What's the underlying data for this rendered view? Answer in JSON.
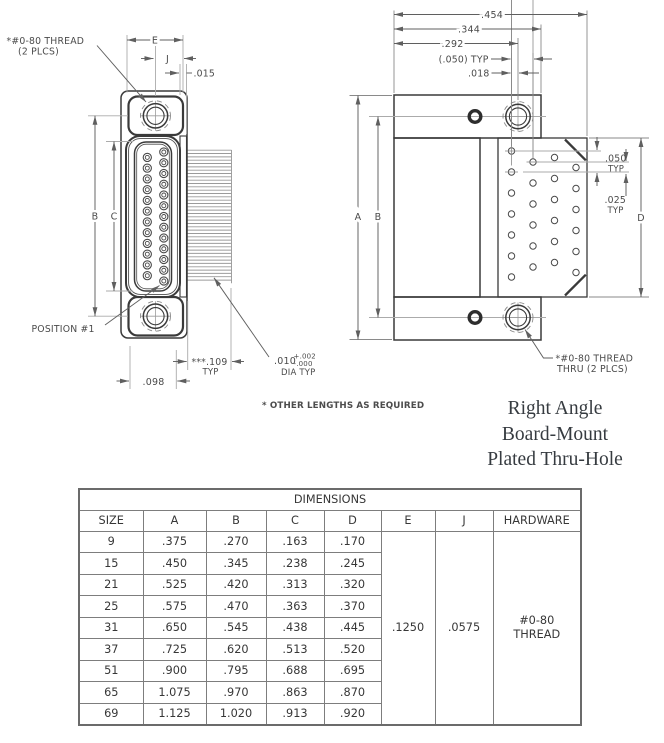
{
  "drawing": {
    "front_view": {
      "thread_label_line1": "*#0-80 THREAD",
      "thread_label_line2": "(2 PLCS)",
      "dim_e": "E",
      "dim_j": "J",
      "dim_015": ".015",
      "dim_b": "B",
      "dim_c": "C",
      "position_label": "POSITION #1",
      "dim_098": ".098",
      "dim_109": "***.109",
      "dim_109_typ": "TYP",
      "dim_010": ".010",
      "dim_010_tol_plus": "+.002",
      "dim_010_tol_minus": "-.000",
      "dim_010_sub": "DIA TYP"
    },
    "side_view": {
      "dim_454": ".454",
      "dim_344": ".344",
      "dim_292": ".292",
      "dim_050_ref": "(.050) TYP",
      "dim_018": ".018",
      "dim_a": "A",
      "dim_b": "B",
      "dim_d": "D",
      "dim_050": ".050",
      "dim_050_typ": "TYP",
      "dim_025": ".025",
      "dim_025_typ": "TYP",
      "thread_label_line1": "*#0-80 THREAD",
      "thread_label_line2": "THRU (2 PLCS)"
    },
    "note": "* OTHER LENGTHS AS REQUIRED"
  },
  "title_block": {
    "line1": "Right Angle",
    "line2": "Board-Mount",
    "line3": "Plated Thru-Hole"
  },
  "table": {
    "title": "DIMENSIONS",
    "headers": [
      "SIZE",
      "A",
      "B",
      "C",
      "D",
      "E",
      "J",
      "HARDWARE"
    ],
    "rows": [
      [
        "9",
        ".375",
        ".270",
        ".163",
        ".170"
      ],
      [
        "15",
        ".450",
        ".345",
        ".238",
        ".245"
      ],
      [
        "21",
        ".525",
        ".420",
        ".313",
        ".320"
      ],
      [
        "25",
        ".575",
        ".470",
        ".363",
        ".370"
      ],
      [
        "31",
        ".650",
        ".545",
        ".438",
        ".445"
      ],
      [
        "37",
        ".725",
        ".620",
        ".513",
        ".520"
      ],
      [
        "51",
        ".900",
        ".795",
        ".688",
        ".695"
      ],
      [
        "65",
        "1.075",
        ".970",
        ".863",
        ".870"
      ],
      [
        "69",
        "1.125",
        "1.020",
        ".913",
        ".920"
      ]
    ],
    "shared": {
      "e": ".1250",
      "j": ".0575",
      "hardware_line1": "#0-80",
      "hardware_line2": "THREAD"
    }
  },
  "colors": {
    "line_dark": "#3a3a3a",
    "line_dim": "#5f5f5f",
    "line_light": "#ababab",
    "hatch": "#9b9b9b",
    "text": "#4a4a4a",
    "table_border": "#7d7d7d",
    "title_text": "#363b40"
  }
}
